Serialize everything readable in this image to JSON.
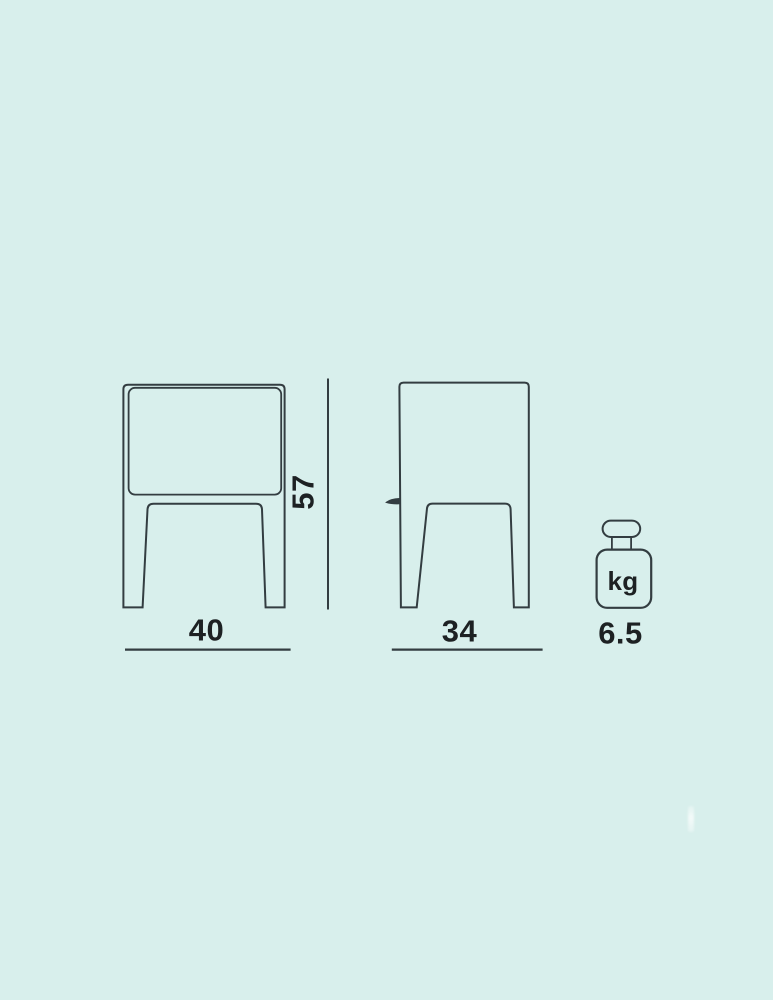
{
  "colors": {
    "background": "#d8efec",
    "stroke": "#333d41",
    "text": "#1d2123"
  },
  "diagram": {
    "type": "product-dimension-drawing",
    "views": {
      "front_view": "front elevation with drawer and two legs",
      "side_view": "side elevation with drawer lip and two legs"
    },
    "dimensions": {
      "width": {
        "value": "40"
      },
      "depth": {
        "value": "34"
      },
      "height": {
        "value": "57"
      },
      "weight": {
        "value": "6.5",
        "unit": "kg",
        "icon": "weight-kilogram-icon"
      }
    }
  }
}
